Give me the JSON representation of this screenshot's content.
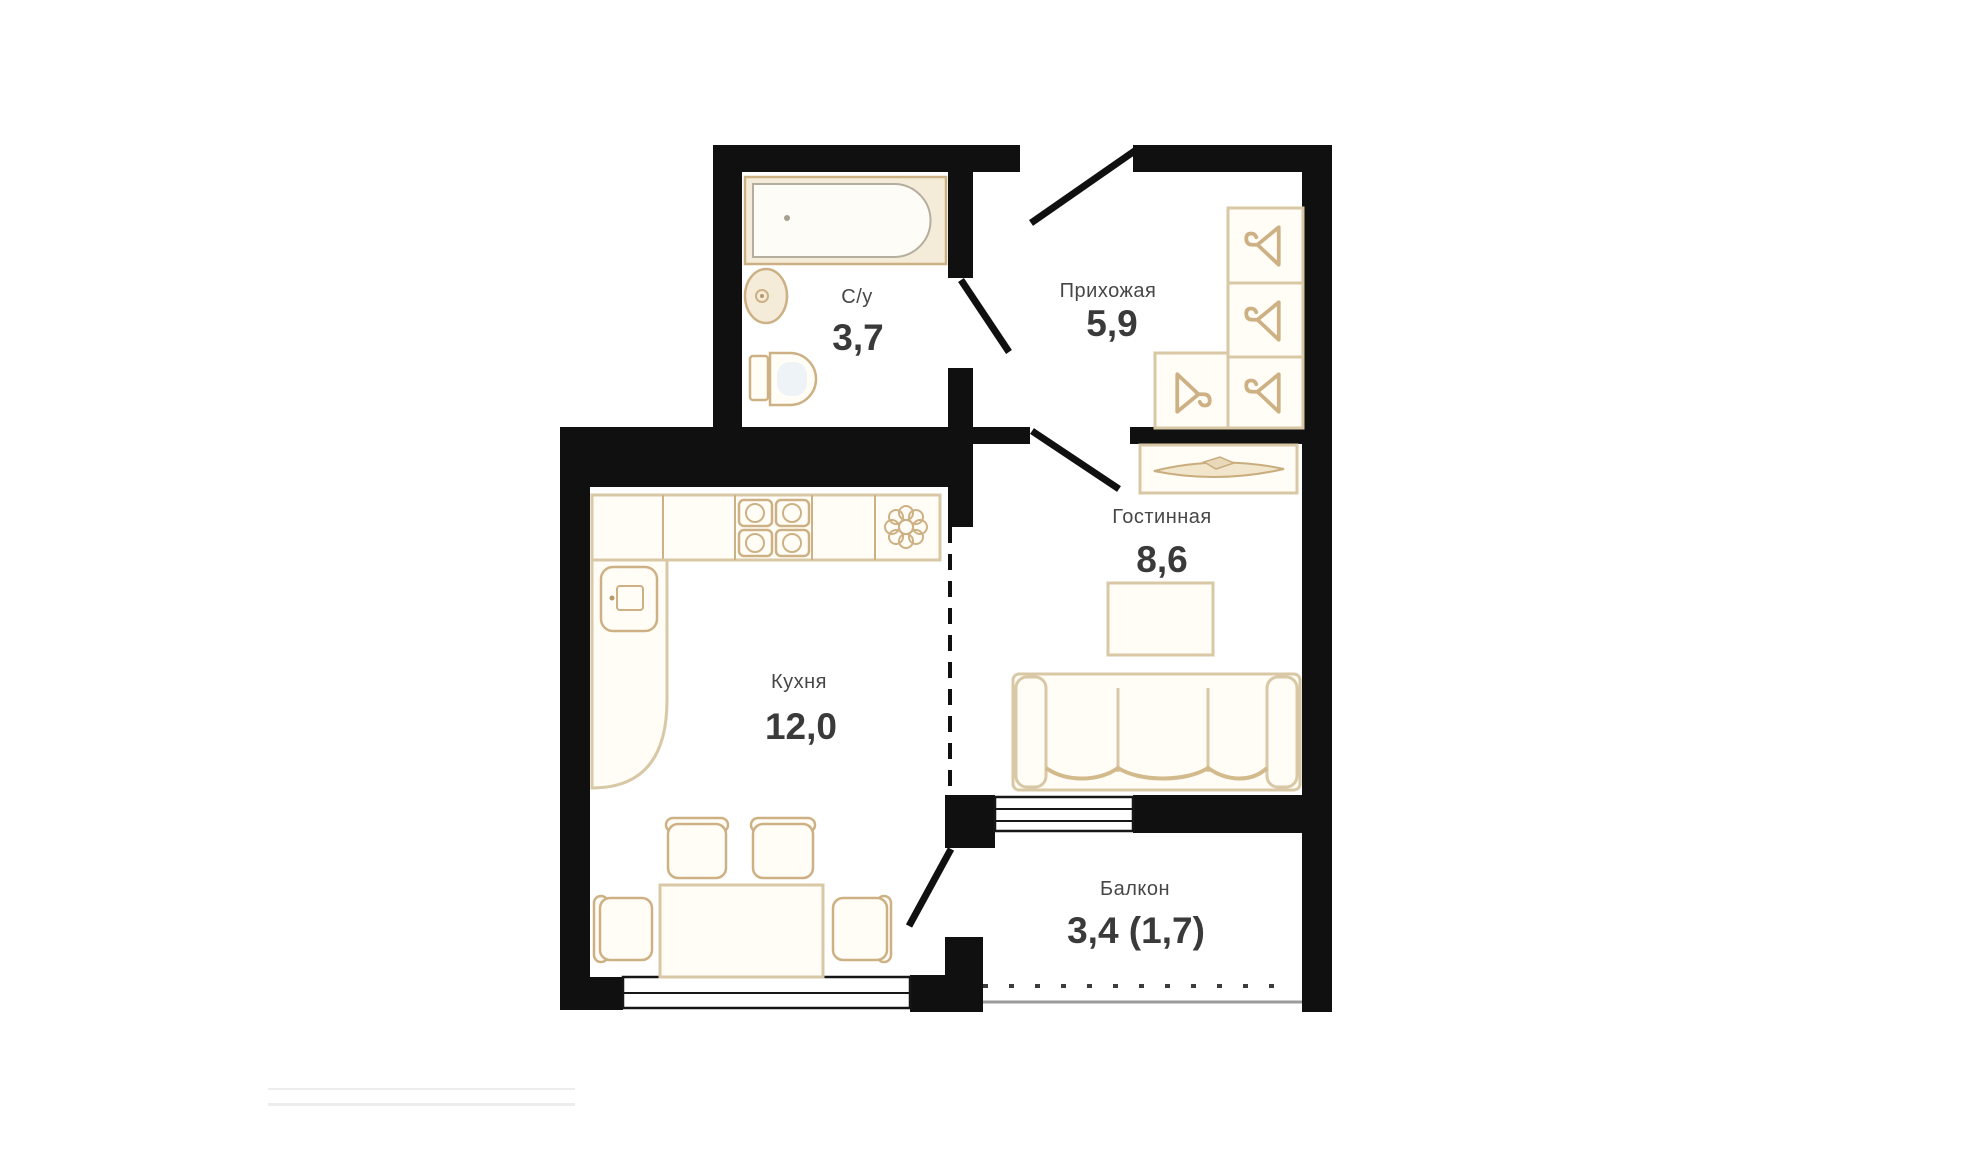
{
  "canvas": {
    "background": "#ffffff"
  },
  "floor_plan": {
    "rooms": [
      {
        "id": "bathroom",
        "name": "С/у",
        "area": "3,7"
      },
      {
        "id": "hallway",
        "name": "Прихожая",
        "area": "5,9"
      },
      {
        "id": "living-room",
        "name": "Гостинная",
        "area": "8,6"
      },
      {
        "id": "kitchen",
        "name": "Кухня",
        "area": "12,0"
      },
      {
        "id": "balcony",
        "name": "Балкон",
        "area": "3,4 (1,7)"
      }
    ],
    "icons": [
      "bathtub-icon",
      "washbasin-icon",
      "toilet-icon",
      "wardrobe-hanger-icon",
      "console-cabinet-icon",
      "coffee-table-icon",
      "sofa-icon",
      "stove-burners-icon",
      "extractor-flower-icon",
      "kitchen-sink-icon",
      "dining-table-icon",
      "chair-icon",
      "entrance-door-icon",
      "interior-door-icon",
      "window-icon",
      "balcony-railing-icon"
    ],
    "colors": {
      "canvas": "#ffffff",
      "wall": "#101010",
      "furniture-stroke": "#cdb185",
      "furniture-stroke-light": "#d8c8a6",
      "furniture-fill": "#fffdf6",
      "cream-fill": "#f4ecd9",
      "tub-inner-stroke": "#b5ad9e",
      "toilet-inner-fill": "#eef3f7",
      "label-name": "#474747",
      "label-area": "#3a3a3a",
      "window-stroke": "#161616",
      "railing-solid": "#9b9b9b",
      "faint-line": "#ededed"
    }
  }
}
